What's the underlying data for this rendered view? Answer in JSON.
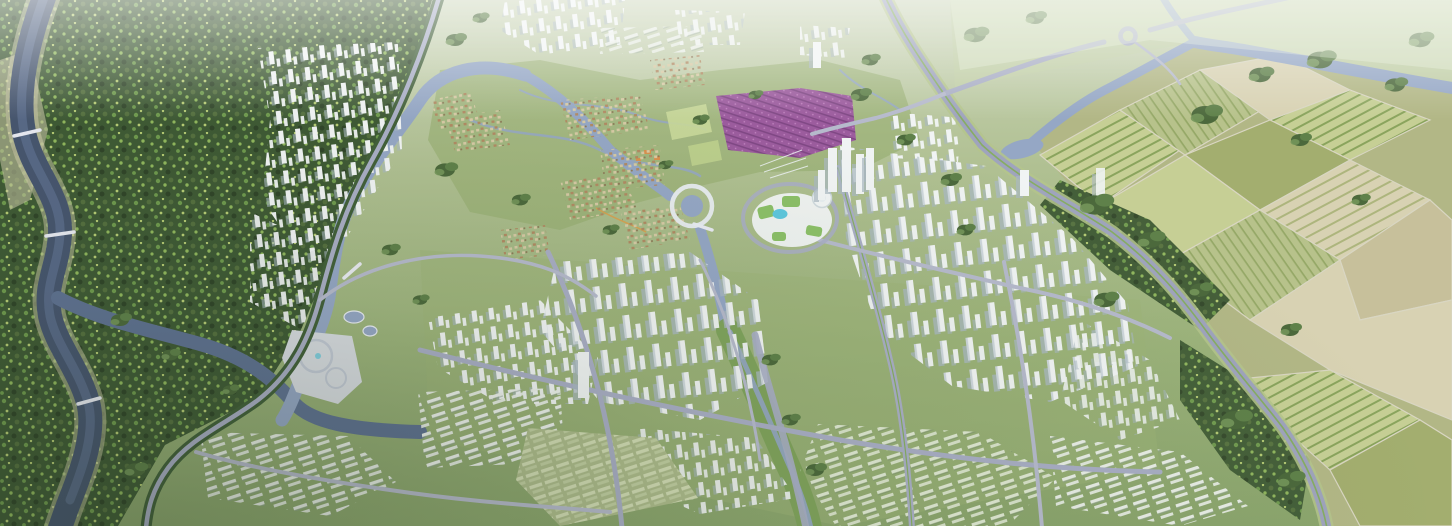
{
  "scene": {
    "type": "aerial-city-masterplan-render",
    "regions": [
      "forest-west",
      "river-west",
      "river-south",
      "heritage-village-island",
      "wetland-park",
      "flower-field",
      "cbd-landmark-cluster",
      "ring-lake",
      "residential-highrise-east",
      "residential-highrise-south",
      "residential-lowrise-southeast",
      "green-terraced-housing",
      "campus-blocks",
      "plaza-with-circles",
      "eastern-boulevard",
      "farmland-east",
      "river-northeast",
      "roundabout-northeast",
      "distant-city-north",
      "tree-lined-avenue"
    ]
  },
  "palette": {
    "bg_top": "#ccd6ba",
    "bg_mid": "#b0c092",
    "bg_low": "#9cb37b",
    "bg_bottom": "#8ba56d",
    "haze": "#f2f5e8",
    "meadow": "#c2cfa6",
    "wetland": "#96ae70",
    "park_green": "#a4b982",
    "forest_base": "#3f5a35",
    "forest_dot1": "#6f9a4e",
    "forest_dot2": "#90b75d",
    "forest_dot3": "#55703f",
    "forest_dot4": "#b7cd75",
    "forest_dot5": "#304529",
    "tree_dark": "#4c693c",
    "tree_mid": "#5f814a",
    "tree_light": "#74965a",
    "water_dark": "#47566f",
    "water_mid": "#5f7292",
    "water_light": "#95a7c5",
    "shore": "#d0ccab",
    "road": "#a9aec5",
    "road_minor": "#b6bacc",
    "road_light": "#e9ebf3",
    "verge": "#b4c48c",
    "median_green": "#86ad62",
    "bld_white": "#f1f4f4",
    "bld_shade": "#a9b8c1",
    "bld_blue": "#dce6e9",
    "green_roof": "#8cc068",
    "pool": "#5ec7dd",
    "village_tan": "#d7caa5",
    "village_roof": "#b18a63",
    "flower": "#9c5c9e",
    "flower_dark": "#7b4480",
    "crop_pale": "#c6cf95",
    "crop_green": "#7f9c53",
    "crop_olive": "#a3ae6f",
    "crop_tan": "#d8d2b3",
    "crop_light": "#c7c09b",
    "lowrise_bar": "#edf1ec",
    "lowrise_green": "#dfe8d2",
    "plaza": "#d8dce1",
    "plaza_line": "#c2c9d5",
    "accent_orange": "#d8914e"
  }
}
